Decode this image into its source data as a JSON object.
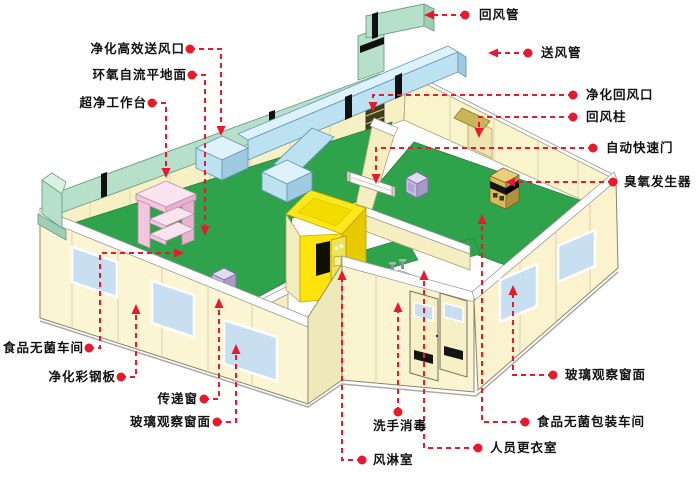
{
  "diagram": {
    "type": "isometric-cleanroom-cutaway",
    "labels": [
      {
        "id": "hepa-supply-outlet",
        "text": "净化高效送风口",
        "side": "left"
      },
      {
        "id": "epoxy-self-leveling-floor",
        "text": "环氧自流平地面",
        "side": "left"
      },
      {
        "id": "clean-bench",
        "text": "超净工作台",
        "side": "left"
      },
      {
        "id": "food-sterile-workshop",
        "text": "食品无菌车间",
        "side": "left"
      },
      {
        "id": "purified-color-steel-panel",
        "text": "净化彩钢板",
        "side": "left"
      },
      {
        "id": "transfer-window",
        "text": "传递窗",
        "side": "left"
      },
      {
        "id": "glass-observation-window-left",
        "text": "玻璃观察窗面",
        "side": "left"
      },
      {
        "id": "return-air-duct",
        "text": "回风管",
        "side": "right"
      },
      {
        "id": "supply-air-duct",
        "text": "送风管",
        "side": "right"
      },
      {
        "id": "purified-return-air-outlet",
        "text": "净化回风口",
        "side": "right"
      },
      {
        "id": "return-air-column",
        "text": "回风柱",
        "side": "right"
      },
      {
        "id": "automatic-rapid-door",
        "text": "自动快速门",
        "side": "right"
      },
      {
        "id": "ozone-generator",
        "text": "臭氧发生器",
        "side": "right"
      },
      {
        "id": "glass-observation-window-right",
        "text": "玻璃观察窗面",
        "side": "right"
      },
      {
        "id": "food-sterile-packaging-workshop",
        "text": "食品无菌包装车间",
        "side": "right"
      },
      {
        "id": "staff-changing-room",
        "text": "人员更衣室",
        "side": "right"
      },
      {
        "id": "hand-wash-disinfection",
        "text": "洗手消毒",
        "side": "bottom"
      },
      {
        "id": "air-shower-room",
        "text": "风淋室",
        "side": "bottom"
      }
    ],
    "colors": {
      "leader_red": "#e8192c",
      "floor_green": "#2fa24c",
      "wall_cream": "#fbf5d4",
      "return_duct_mint": "#b7e0ca",
      "supply_duct_blue": "#bce2f2",
      "air_shower_yellow": "#ffe30a",
      "clean_bench_pink": "#f2c6dc",
      "window_blue": "#c8dff2",
      "ozone_cabinet_tan": "#d8bc5c"
    }
  }
}
